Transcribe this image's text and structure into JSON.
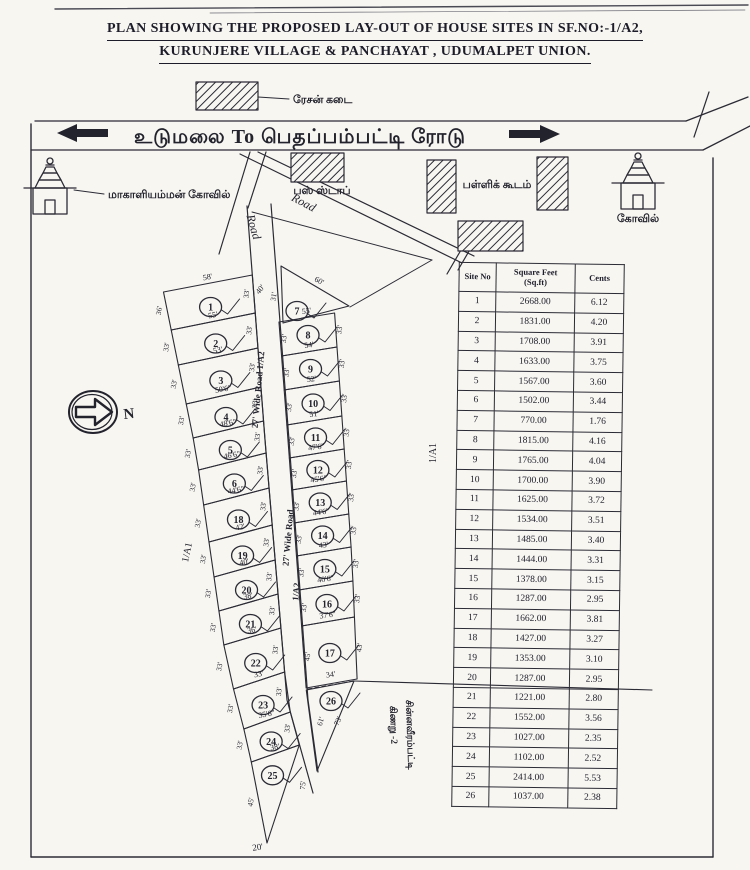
{
  "title": {
    "line1": "PLAN SHOWING THE PROPOSED LAY-OUT OF HOUSE SITES IN SF.NO:-1/A2,",
    "line2": "KURUNJERE VILLAGE & PANCHAYAT , UDUMALPET UNION."
  },
  "main_road": {
    "label": "உடுமலை  To  பெதப்பம்பட்டி  ரோடு"
  },
  "north_label": "N",
  "legend": {
    "ration_shop": "ரேசன் கடை",
    "bus_stop": "பஸ் ஸ்டாப்",
    "school": "பள்ளிக் கூடம்",
    "temple_left": "மாகாளியம்மன் கோவில்",
    "temple_right": "கோவில்"
  },
  "road_labels": {
    "diagonal_left": "Road",
    "diagonal_right": "Road",
    "middle_upper": "27' Wide Road  1/A2",
    "middle_lower": "27' Wide Road",
    "middle_lower2": "1/A2"
  },
  "area_labels": {
    "left_survey": "1/A1",
    "right_survey": "1/A1",
    "float_dim": "40'",
    "bottom_tip": "20'",
    "well_line1": "கிணறு -2",
    "well_line2": "சின்னவீரம்பட்டி"
  },
  "plots": {
    "left": [
      {
        "no": "1",
        "dim": "58'",
        "side_l": "36'",
        "side_r": "33'"
      },
      {
        "no": "2",
        "dim": "55'",
        "side_l": "33'",
        "side_r": "33'"
      },
      {
        "no": "3",
        "dim": "53'",
        "side_l": "33'",
        "side_r": "33'"
      },
      {
        "no": "4",
        "dim": "50'6\"",
        "side_l": "33'",
        "side_r": "33'"
      },
      {
        "no": "5",
        "dim": "48'6\"",
        "side_l": "33'",
        "side_r": "33'"
      },
      {
        "no": "6",
        "dim": "46'6\"",
        "side_l": "33'",
        "side_r": "33'"
      },
      {
        "no": "18",
        "dim": "44'6\"",
        "side_l": "33'",
        "side_r": "33'"
      },
      {
        "no": "19",
        "dim": "42'",
        "side_l": "33'",
        "side_r": "33'"
      },
      {
        "no": "20",
        "dim": "40'",
        "side_l": "33'",
        "side_r": "33'"
      },
      {
        "no": "21",
        "dim": "38'",
        "side_l": "33'",
        "side_r": "33'"
      },
      {
        "no": "22",
        "dim": "36'",
        "side_l": "33'",
        "side_r": "33'"
      },
      {
        "no": "23",
        "dim": "33'",
        "side_l": "33'",
        "side_r": "33'"
      },
      {
        "no": "24",
        "dim": "35'6\"",
        "side_l": "33'",
        "side_r": "33'"
      },
      {
        "no": "25",
        "dim": "38'",
        "side_l": "45'",
        "side_r": "75'"
      }
    ],
    "right": [
      {
        "no": "7",
        "dim": "60'",
        "side_l": "31'",
        "side_r": ""
      },
      {
        "no": "8",
        "dim": "55'",
        "side_l": "33'",
        "side_r": "33'"
      },
      {
        "no": "9",
        "dim": "54'",
        "side_l": "33'",
        "side_r": "33'"
      },
      {
        "no": "10",
        "dim": "52'",
        "side_l": "33'",
        "side_r": "33'"
      },
      {
        "no": "11",
        "dim": "51'",
        "side_l": "33'",
        "side_r": "33'"
      },
      {
        "no": "12",
        "dim": "47'6\"",
        "side_l": "33'",
        "side_r": "33'"
      },
      {
        "no": "13",
        "dim": "45'6\"",
        "side_l": "33'",
        "side_r": "33'"
      },
      {
        "no": "14",
        "dim": "44'6\"",
        "side_l": "33'",
        "side_r": "33'"
      },
      {
        "no": "15",
        "dim": "43'",
        "side_l": "33'",
        "side_r": "33'"
      },
      {
        "no": "16",
        "dim": "40'6\"",
        "side_l": "33'",
        "side_r": "33'"
      },
      {
        "no": "17",
        "dim": "37'6\"",
        "side_l": "45'",
        "side_r": "43'"
      },
      {
        "no": "26",
        "dim": "34'",
        "side_l": "61'",
        "side_r": "73'"
      }
    ]
  },
  "table": {
    "headers": {
      "col1": "Site No",
      "col2_line1": "Square Feet",
      "col2_line2": "(Sq.ft)",
      "col3": "Cents"
    },
    "rows": [
      {
        "no": "1",
        "sqft": "2668.00",
        "cents": "6.12"
      },
      {
        "no": "2",
        "sqft": "1831.00",
        "cents": "4.20"
      },
      {
        "no": "3",
        "sqft": "1708.00",
        "cents": "3.91"
      },
      {
        "no": "4",
        "sqft": "1633.00",
        "cents": "3.75"
      },
      {
        "no": "5",
        "sqft": "1567.00",
        "cents": "3.60"
      },
      {
        "no": "6",
        "sqft": "1502.00",
        "cents": "3.44"
      },
      {
        "no": "7",
        "sqft": "770.00",
        "cents": "1.76"
      },
      {
        "no": "8",
        "sqft": "1815.00",
        "cents": "4.16"
      },
      {
        "no": "9",
        "sqft": "1765.00",
        "cents": "4.04"
      },
      {
        "no": "10",
        "sqft": "1700.00",
        "cents": "3.90"
      },
      {
        "no": "11",
        "sqft": "1625.00",
        "cents": "3.72"
      },
      {
        "no": "12",
        "sqft": "1534.00",
        "cents": "3.51"
      },
      {
        "no": "13",
        "sqft": "1485.00",
        "cents": "3.40"
      },
      {
        "no": "14",
        "sqft": "1444.00",
        "cents": "3.31"
      },
      {
        "no": "15",
        "sqft": "1378.00",
        "cents": "3.15"
      },
      {
        "no": "16",
        "sqft": "1287.00",
        "cents": "2.95"
      },
      {
        "no": "17",
        "sqft": "1662.00",
        "cents": "3.81"
      },
      {
        "no": "18",
        "sqft": "1427.00",
        "cents": "3.27"
      },
      {
        "no": "19",
        "sqft": "1353.00",
        "cents": "3.10"
      },
      {
        "no": "20",
        "sqft": "1287.00",
        "cents": "2.95"
      },
      {
        "no": "21",
        "sqft": "1221.00",
        "cents": "2.80"
      },
      {
        "no": "22",
        "sqft": "1552.00",
        "cents": "3.56"
      },
      {
        "no": "23",
        "sqft": "1027.00",
        "cents": "2.35"
      },
      {
        "no": "24",
        "sqft": "1102.00",
        "cents": "2.52"
      },
      {
        "no": "25",
        "sqft": "2414.00",
        "cents": "5.53"
      },
      {
        "no": "26",
        "sqft": "1037.00",
        "cents": "2.38"
      }
    ]
  },
  "colors": {
    "ink": "#2b2b36",
    "paper": "#f8f6f1"
  }
}
